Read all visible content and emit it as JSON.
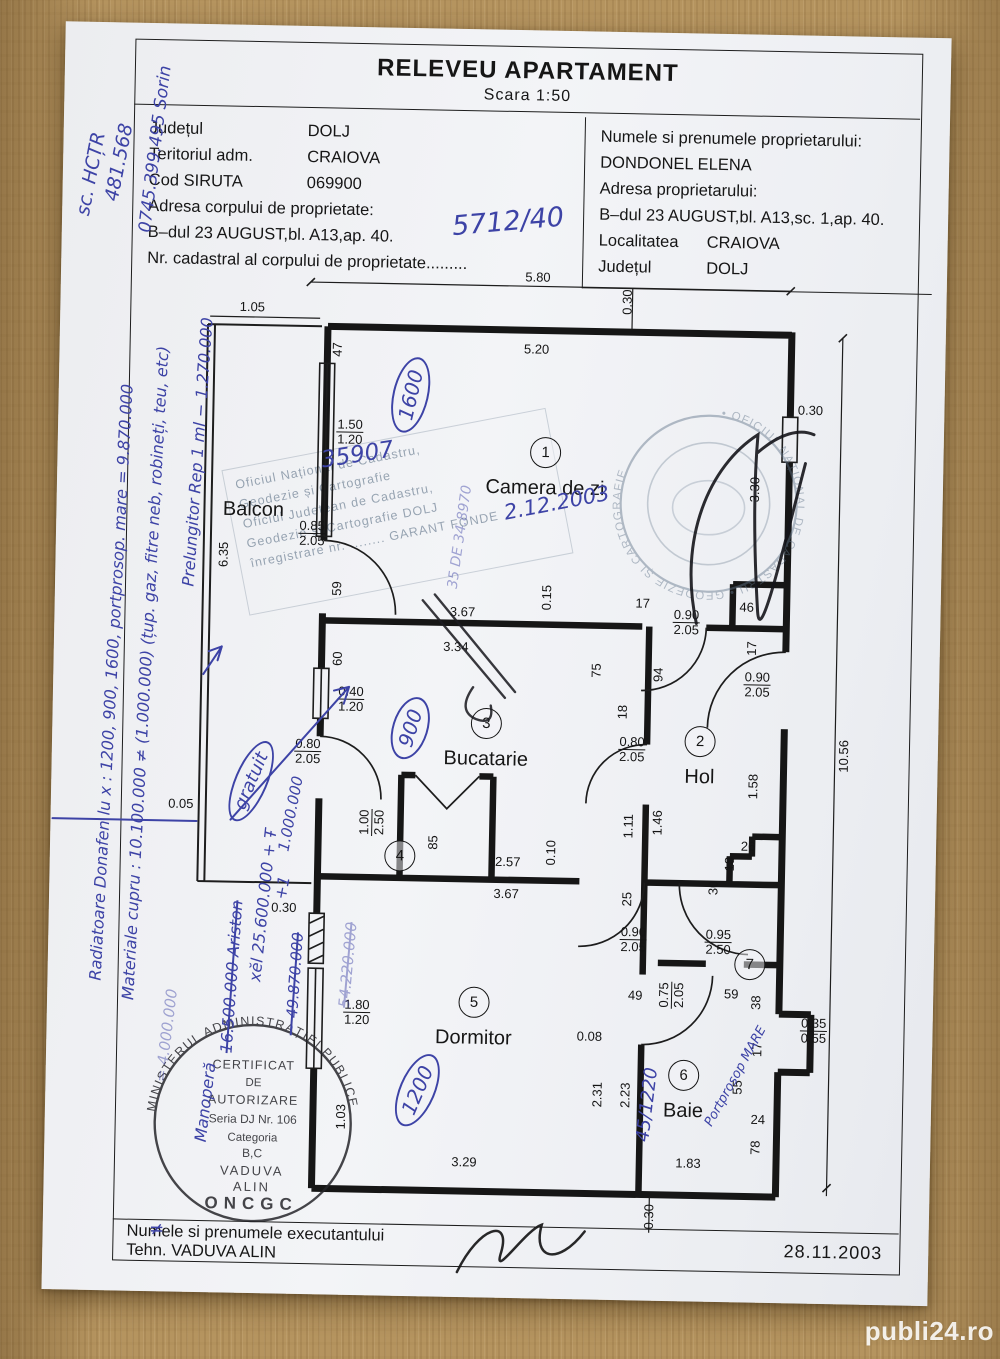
{
  "watermark": "publi24.ro",
  "colors": {
    "ink_blue": "#3d43a6",
    "print_black": "#1a1a1a",
    "paper": "#f1f2f5",
    "wood": "#b5945f",
    "stamp_faded": "#5f7388"
  },
  "header": {
    "title": "RELEVEU APARTAMENT",
    "scale": "Scara 1:50",
    "left": {
      "rows": [
        {
          "label": "Județul",
          "value": "DOLJ"
        },
        {
          "label": "Teritoriul adm.",
          "value": "CRAIOVA"
        },
        {
          "label": "Cod SIRUTA",
          "value": "069900"
        }
      ],
      "address_label": "Adresa corpului de proprietate:",
      "address": "B–dul 23 AUGUST,bl. A13,ap. 40.",
      "cadastral_label": "Nr. cadastral al corpului de proprietate........."
    },
    "right": {
      "owner_label": "Numele si prenumele proprietarului:",
      "owner": "DONDONEL ELENA",
      "address_label": "Adresa proprietarului:",
      "address": "B–dul 23 AUGUST,bl. A13,sc. 1,ap. 40.",
      "rows": [
        {
          "label": "Localitatea",
          "value": "CRAIOVA"
        },
        {
          "label": "Județul",
          "value": "DOLJ"
        }
      ]
    }
  },
  "plan": {
    "rooms": [
      {
        "n": "1",
        "label": "Camera de zi",
        "x": 348,
        "y": 180
      },
      {
        "n": "2",
        "label": "Hol",
        "x": 508,
        "y": 466
      },
      {
        "n": "3",
        "label": "Bucatarie",
        "x": 294,
        "y": 452
      },
      {
        "n": "4",
        "label": "",
        "x": 210,
        "y": 586
      },
      {
        "n": "5",
        "label": "Dormitor",
        "x": 287,
        "y": 731
      },
      {
        "n": "6",
        "label": "Baie",
        "x": 498,
        "y": 800
      },
      {
        "n": "7",
        "label": "",
        "x": 562,
        "y": 688
      },
      {
        "n": "",
        "label": "Balcon",
        "x": 57,
        "y": 243
      }
    ],
    "dims": [
      {
        "t": "5.80",
        "x": 337,
        "y": 5
      },
      {
        "t": "0.30",
        "x": 427,
        "y": 28,
        "r": -90
      },
      {
        "t": "1.05",
        "x": 52,
        "y": 40
      },
      {
        "t": "47",
        "x": 138,
        "y": 81,
        "r": -90
      },
      {
        "t": "5.20",
        "x": 337,
        "y": 77
      },
      {
        "t": "0.30",
        "x": 612,
        "y": 133
      },
      {
        "t": "1.50|1.20",
        "x": 152,
        "y": 163
      },
      {
        "t": "3.30",
        "x": 558,
        "y": 213,
        "r": -90
      },
      {
        "t": "0.85|2.05",
        "x": 116,
        "y": 265
      },
      {
        "t": "6.35",
        "x": 28,
        "y": 288,
        "r": -90
      },
      {
        "t": "59",
        "x": 142,
        "y": 320,
        "r": -90
      },
      {
        "t": "0.15",
        "x": 352,
        "y": 325,
        "r": -90
      },
      {
        "t": "3.67",
        "x": 268,
        "y": 341
      },
      {
        "t": "17",
        "x": 448,
        "y": 329
      },
      {
        "t": "46",
        "x": 552,
        "y": 331
      },
      {
        "t": "0.90|2.05",
        "x": 492,
        "y": 347
      },
      {
        "t": "17",
        "x": 558,
        "y": 372,
        "r": -90
      },
      {
        "t": "3.34",
        "x": 262,
        "y": 376
      },
      {
        "t": "60",
        "x": 144,
        "y": 390,
        "r": -90
      },
      {
        "t": "0.40|1.20",
        "x": 158,
        "y": 430
      },
      {
        "t": "75",
        "x": 403,
        "y": 397,
        "r": -90
      },
      {
        "t": "94",
        "x": 465,
        "y": 400,
        "r": -90
      },
      {
        "t": "18",
        "x": 430,
        "y": 438,
        "r": -90
      },
      {
        "t": "0.80|2.05",
        "x": 440,
        "y": 475
      },
      {
        "t": "0.80|2.05",
        "x": 116,
        "y": 483
      },
      {
        "t": "0.90|2.05",
        "x": 564,
        "y": 408
      },
      {
        "t": "1.58",
        "x": 562,
        "y": 510,
        "r": -90
      },
      {
        "t": "10.56",
        "x": 652,
        "y": 478,
        "r": -90
      },
      {
        "t": "1.11",
        "x": 438,
        "y": 552,
        "r": -90
      },
      {
        "t": "1.46",
        "x": 467,
        "y": 548,
        "r": -90
      },
      {
        "t": "26",
        "x": 558,
        "y": 570
      },
      {
        "t": "18",
        "x": 540,
        "y": 588,
        "r": -90
      },
      {
        "t": "30",
        "x": 524,
        "y": 612,
        "r": -90
      },
      {
        "t": "1.00|2.50",
        "x": 181,
        "y": 553,
        "r": -90
      },
      {
        "t": "85",
        "x": 243,
        "y": 572,
        "r": -90
      },
      {
        "t": "2.57",
        "x": 318,
        "y": 590
      },
      {
        "t": "0.10",
        "x": 361,
        "y": 580,
        "r": -90
      },
      {
        "t": "0.30",
        "x": 95,
        "y": 640
      },
      {
        "t": "0.05",
        "x": -10,
        "y": 538
      },
      {
        "t": "3.67",
        "x": 317,
        "y": 622
      },
      {
        "t": "25",
        "x": 438,
        "y": 625,
        "r": -90
      },
      {
        "t": "0.90|2.05",
        "x": 445,
        "y": 665
      },
      {
        "t": "49",
        "x": 448,
        "y": 721
      },
      {
        "t": "0.95|2.50",
        "x": 530,
        "y": 666
      },
      {
        "t": "0.75|2.05",
        "x": 484,
        "y": 720,
        "r": -90
      },
      {
        "t": "59",
        "x": 544,
        "y": 718
      },
      {
        "t": "38",
        "x": 569,
        "y": 726,
        "r": -90
      },
      {
        "t": "0.35|0.55",
        "x": 627,
        "y": 753
      },
      {
        "t": "17",
        "x": 571,
        "y": 773,
        "r": -90
      },
      {
        "t": "55",
        "x": 552,
        "y": 811,
        "r": -90
      },
      {
        "t": "24",
        "x": 573,
        "y": 843
      },
      {
        "t": "78",
        "x": 571,
        "y": 871,
        "r": -90
      },
      {
        "t": "0.08",
        "x": 403,
        "y": 763
      },
      {
        "t": "2.31",
        "x": 412,
        "y": 821,
        "r": -90
      },
      {
        "t": "2.23",
        "x": 440,
        "y": 821,
        "r": -90
      },
      {
        "t": "1.80|1.20",
        "x": 170,
        "y": 743
      },
      {
        "t": "1.03",
        "x": 156,
        "y": 848,
        "r": -90
      },
      {
        "t": "3.29",
        "x": 280,
        "y": 891
      },
      {
        "t": "1.83",
        "x": 504,
        "y": 888
      },
      {
        "t": "0.30",
        "x": 466,
        "y": 942,
        "r": -90
      }
    ]
  },
  "notes": [
    {
      "t": "sc. HCȚR",
      "x": 28,
      "y": 152,
      "r": -80,
      "s": 19
    },
    {
      "t": "481.568",
      "x": 56,
      "y": 140,
      "r": -80,
      "s": 19
    },
    {
      "t": "0745.399.495  Sorin",
      "x": 92,
      "y": 126,
      "r": -84,
      "s": 17
    },
    {
      "t": "5712/40",
      "x": 446,
      "y": 192,
      "r": -6,
      "s": 27
    },
    {
      "t": "Radiatoare Donafen lu x : 1200, 900, 1600, portprosop. mare = 9.870.000",
      "x": 58,
      "y": 660,
      "r": -88,
      "s": 16
    },
    {
      "t": "Materiale cupru : 10.100.000 ≠ (1.000.000)  (țup. gaz, fitre neb, robineți, teu, etc)",
      "x": 92,
      "y": 650,
      "r": -88,
      "s": 16
    },
    {
      "t": "Prelungitor  Rep  1 ml  − 1.270.000",
      "x": 140,
      "y": 428,
      "r": -87,
      "s": 16
    },
    {
      "t": "= 4.000.000",
      "x": 120,
      "y": 1012,
      "r": -84,
      "s": 15,
      "c": "faint"
    },
    {
      "t": "Manoperă",
      "x": 160,
      "y": 1078,
      "r": -84,
      "s": 16
    },
    {
      "t": "16.500.000  Ariston",
      "x": 184,
      "y": 952,
      "r": -87,
      "s": 16,
      "c": "strike"
    },
    {
      "t": "xĕl  25.600.000 + Ŧ",
      "x": 214,
      "y": 880,
      "r": -85,
      "s": 16
    },
    {
      "t": "gratuit",
      "x": 200,
      "y": 756,
      "r": -68,
      "s": 18,
      "c": "circled"
    },
    {
      "t": "1.000.000",
      "x": 240,
      "y": 788,
      "r": -80,
      "s": 15
    },
    {
      "t": "+1",
      "x": 233,
      "y": 862,
      "r": -80,
      "s": 16
    },
    {
      "t": "~ 49.870.000",
      "x": 247,
      "y": 958,
      "r": -87,
      "s": 15,
      "c": "strike"
    },
    {
      "t": "54.220.000",
      "x": 300,
      "y": 938,
      "r": -86,
      "s": 15,
      "c": "strike faint"
    },
    {
      "t": "35907",
      "x": 300,
      "y": 428,
      "r": -10,
      "s": 23
    },
    {
      "t": "2.12.2003",
      "x": 500,
      "y": 472,
      "r": -12,
      "s": 21
    },
    {
      "t": "1600",
      "x": 352,
      "y": 367,
      "r": -78,
      "s": 20,
      "c": "circled"
    },
    {
      "t": "900",
      "x": 358,
      "y": 700,
      "r": -74,
      "s": 20,
      "c": "circled"
    },
    {
      "t": "1200",
      "x": 372,
      "y": 1062,
      "r": -68,
      "s": 20,
      "c": "circled"
    },
    {
      "t": "45/1220",
      "x": 602,
      "y": 1072,
      "r": -84,
      "s": 18
    },
    {
      "t": "Portprosop MARE",
      "x": 690,
      "y": 1042,
      "r": -62,
      "s": 13
    },
    {
      "t": "35 DE 34.8970",
      "x": 404,
      "y": 508,
      "r": -83,
      "s": 14,
      "c": "faint"
    },
    {
      "t": "≠",
      "x": 114,
      "y": 1206,
      "r": 0,
      "s": 18
    }
  ],
  "stamps": {
    "round_bottom": {
      "ring": "MINISTERUL  ADMINISTRAȚIEI  PUBLICE",
      "bottom": "ONCGC",
      "lines": [
        "CERTIFICAT",
        "DE",
        "AUTORIZARE",
        "Seria DJ Nr. 106",
        "Categoria",
        "B,C",
        "VADUVA",
        "ALIN"
      ]
    },
    "round_top": {
      "ring": "• OFICIUL NAȚIONAL DE CADASTRU • GEODEZIE ȘI CARTOGRAFIE"
    },
    "rect": {
      "lines": [
        "Oficiul Național de Cadastru,",
        "Geodezie și Cartografie",
        "Oficiul Județean de Cadastru,",
        "Geodezie și Cartografie  DOLJ",
        "înregistrare nr. ........  GARANT  FONDE"
      ]
    }
  },
  "footer": {
    "name_label": "Numele si prenumele executantului",
    "name": "Tehn.  VADUVA  ALIN",
    "date": "28.11.2003"
  }
}
